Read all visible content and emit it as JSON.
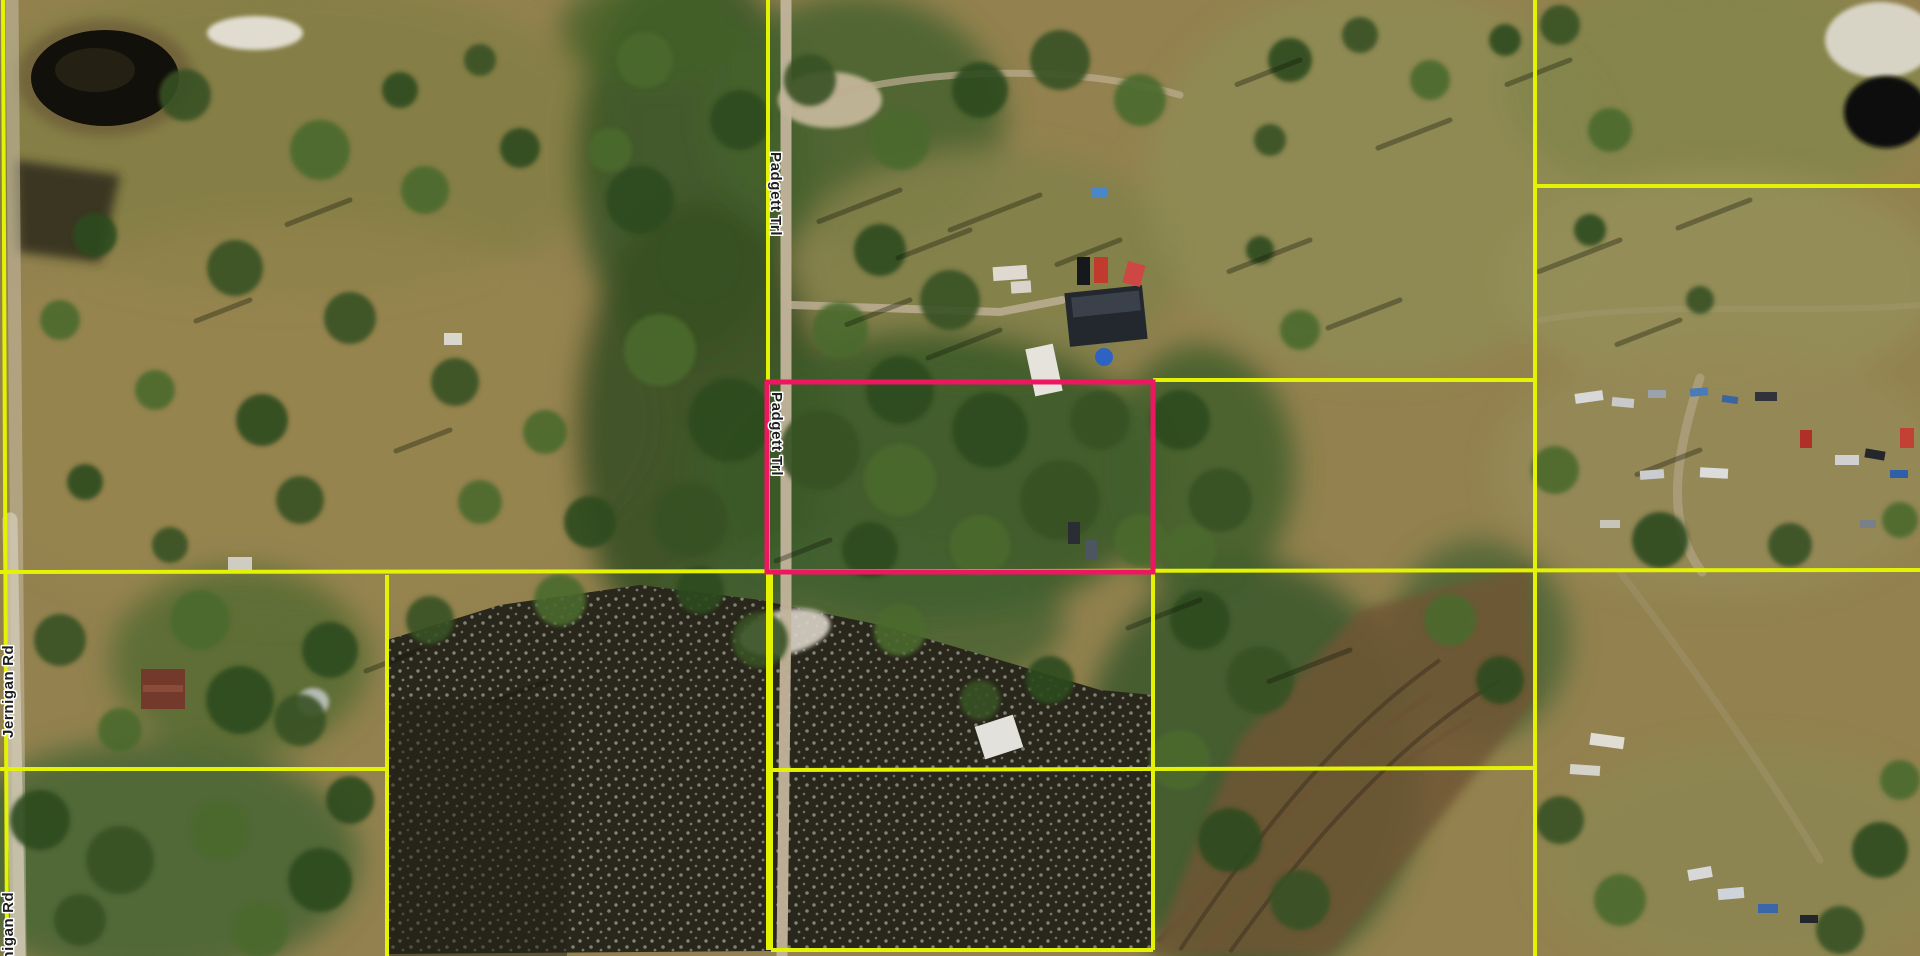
{
  "map": {
    "view_type": "satellite-aerial-parcel-view",
    "colors": {
      "parcel_line": "#e4f203",
      "highlight": "#ee1660",
      "label_fill": "#1e1e1e",
      "label_halo": "#ffffff"
    },
    "road_labels": [
      {
        "id": "padgett-trl-north",
        "text": "Padgett Trl",
        "x": 771,
        "y": 152,
        "rotation": 90
      },
      {
        "id": "padgett-trl-south",
        "text": "Padgett Trl",
        "x": 772,
        "y": 392,
        "rotation": 90
      },
      {
        "id": "jernigan-rd-upper",
        "text": "Jernigan Rd",
        "x": 13,
        "y": 738,
        "rotation": -90
      },
      {
        "id": "jernigan-rd-lower",
        "text": "Jernigan Rd",
        "x": 13,
        "y": 985,
        "rotation": -90
      }
    ],
    "highlight_parcel": {
      "x": 767,
      "y": 382,
      "width": 386,
      "height": 190,
      "stroke_width": 5
    },
    "parcel_lines": [
      {
        "name": "jernigan-rd-edge",
        "points": [
          [
            3,
            0
          ],
          [
            7,
            956
          ]
        ]
      },
      {
        "name": "padgett-trl-boundary",
        "points": [
          [
            768,
            0
          ],
          [
            768,
            950
          ]
        ]
      },
      {
        "name": "central-horizontal",
        "points": [
          [
            0,
            572
          ],
          [
            1920,
            570
          ]
        ]
      },
      {
        "name": "northeast-parcel-horizontal",
        "points": [
          [
            1153,
            380
          ],
          [
            1535,
            380
          ]
        ]
      },
      {
        "name": "east-vertical",
        "points": [
          [
            1535,
            0
          ],
          [
            1535,
            956
          ]
        ]
      },
      {
        "name": "far-northeast-horizontal",
        "points": [
          [
            1535,
            186
          ],
          [
            1920,
            186
          ]
        ]
      },
      {
        "name": "south-center-horizontal",
        "points": [
          [
            771,
            770
          ],
          [
            1535,
            768
          ]
        ]
      },
      {
        "name": "south-center-left-vertical",
        "points": [
          [
            771,
            572
          ],
          [
            771,
            950
          ]
        ]
      },
      {
        "name": "south-center-right-vertical",
        "points": [
          [
            1153,
            572
          ],
          [
            1153,
            950
          ]
        ]
      },
      {
        "name": "south-center-bottom",
        "points": [
          [
            771,
            950
          ],
          [
            1153,
            950
          ]
        ]
      },
      {
        "name": "southwest-horizontal",
        "points": [
          [
            0,
            769
          ],
          [
            387,
            769
          ]
        ]
      },
      {
        "name": "west-vertical",
        "points": [
          [
            387,
            575
          ],
          [
            387,
            956
          ]
        ]
      }
    ]
  }
}
